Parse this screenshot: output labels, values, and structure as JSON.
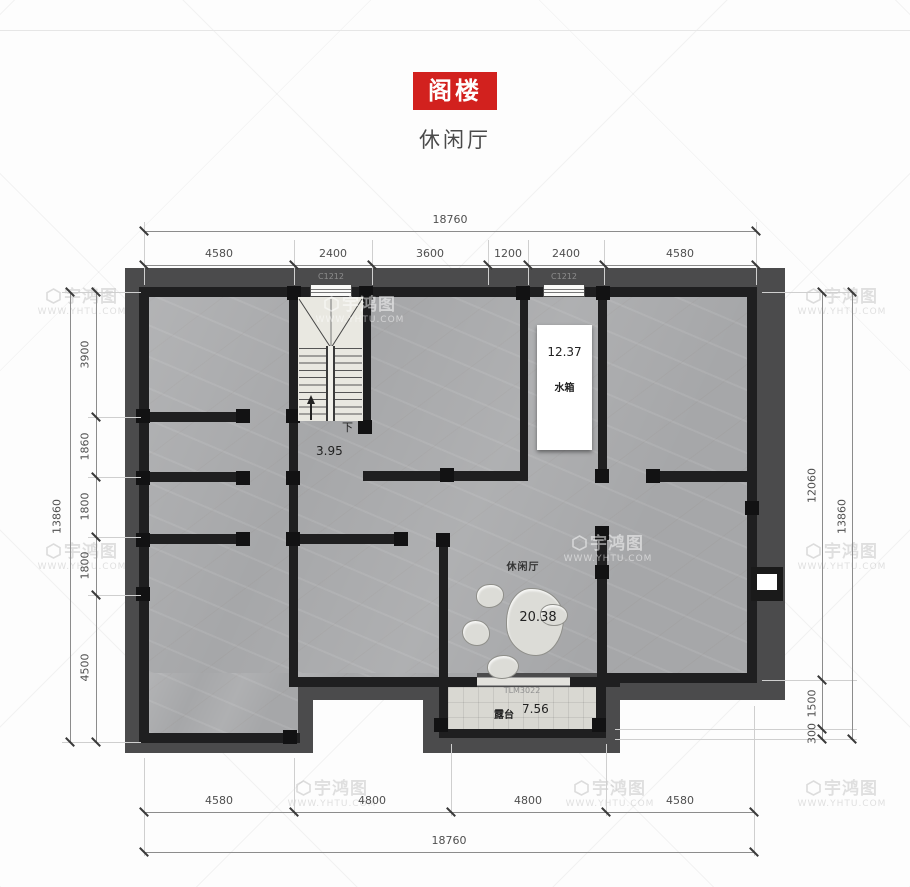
{
  "header": {
    "badge": "阁楼",
    "subtitle": "休闲厅",
    "badge_color": "#d2211e"
  },
  "watermark": {
    "brand": "宇鸿图",
    "url": "WWW.YHTU.COM"
  },
  "dimensions": {
    "top": {
      "overall": "18760",
      "segments": [
        "4580",
        "2400",
        "3600",
        "1200",
        "2400",
        "4580"
      ]
    },
    "bottom": {
      "overall": "18760",
      "segments": [
        "4580",
        "4800",
        "4800",
        "4580"
      ]
    },
    "left": {
      "overall": "13860",
      "segments": [
        "3900",
        "1860",
        "1800",
        "1800",
        "4500"
      ]
    },
    "right": {
      "overall": "13860",
      "segments": [
        "12060",
        "1500",
        "300"
      ]
    }
  },
  "plan": {
    "windows": [
      "C1212",
      "C1212"
    ],
    "stair": {
      "down": "下",
      "value": "3.95"
    },
    "water_tank": {
      "name": "水箱",
      "value": "12.37"
    },
    "lounge": {
      "name": "休闲厅",
      "value": "20.38"
    },
    "terrace": {
      "name": "露台",
      "value": "7.56",
      "door": "TLM3022"
    }
  }
}
